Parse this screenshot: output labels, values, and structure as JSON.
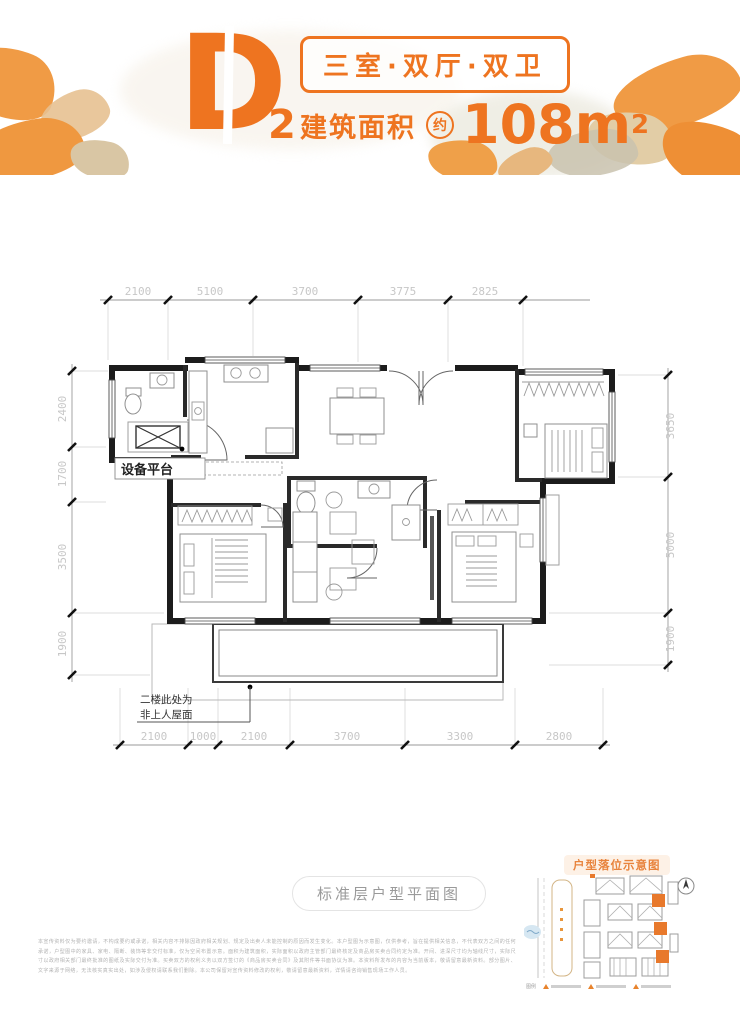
{
  "colors": {
    "brand_orange": "#ee7420",
    "wall_black": "#1c1c1c",
    "dim_gray": "#c7c7c7",
    "minimap_orange": "#e8832c"
  },
  "header": {
    "unit_letter": "D",
    "unit_sub": "2",
    "type_tag": "三室·双厅·双卫",
    "area_label": "建筑面积",
    "approx_badge": "约",
    "area_value": "108m",
    "area_exponent": "2"
  },
  "floor_plan": {
    "dims_top": [
      "2100",
      "5100",
      "3700",
      "3775",
      "2825"
    ],
    "dims_bottom": [
      "2100",
      "1000",
      "2100",
      "3700",
      "3300",
      "2800"
    ],
    "dims_left": [
      "2400",
      "1700",
      "3500",
      "1900"
    ],
    "dims_right": [
      "3650",
      "5000",
      "1900"
    ],
    "equipment_platform": "设备平台",
    "roof_note_line1": "二楼此处为",
    "roof_note_line2": "非上人屋面"
  },
  "caption": {
    "label": "标准层户型平面图"
  },
  "minimap": {
    "title": "户型落位示意图",
    "legend_label": "图例",
    "legend_items": [
      {
        "icon": "triangle-marker"
      },
      {
        "icon": "triangle-marker"
      },
      {
        "icon": "triangle-marker"
      }
    ]
  },
  "disclaimer": {
    "text": "本宣传资料仅为要约邀请，不构成要约或承诺，相关内容不排除因政府相关规划、规定及出卖人未能控制的原因而发生变化。本户型图为示意图，仅供参考，旨在提供相关信息，不代表双方之间的任何承诺，户型图中的家具、家电、隔断、装饰等非交付标准，仅为空间布置示意。面积为建筑面积，实际面积以政府主管部门最终核定及商品房买卖合同约定为准。开间、进深尺寸均为轴线尺寸，实际尺寸以政府相关部门最终批准的图纸及实际交付为准。买卖双方的权利义务以双方签订的《商品房买卖合同》及其附件等书面协议为准。本资料所发布的内容为当前版本，敬请留意最新资料。部分图片、文字来源于网络，无法核实真实出处，如涉及侵权请联系我们删除。本公司保留对宣传资料修改的权利，敬请留意最新资料，详情请咨询销售现场工作人员。"
  }
}
